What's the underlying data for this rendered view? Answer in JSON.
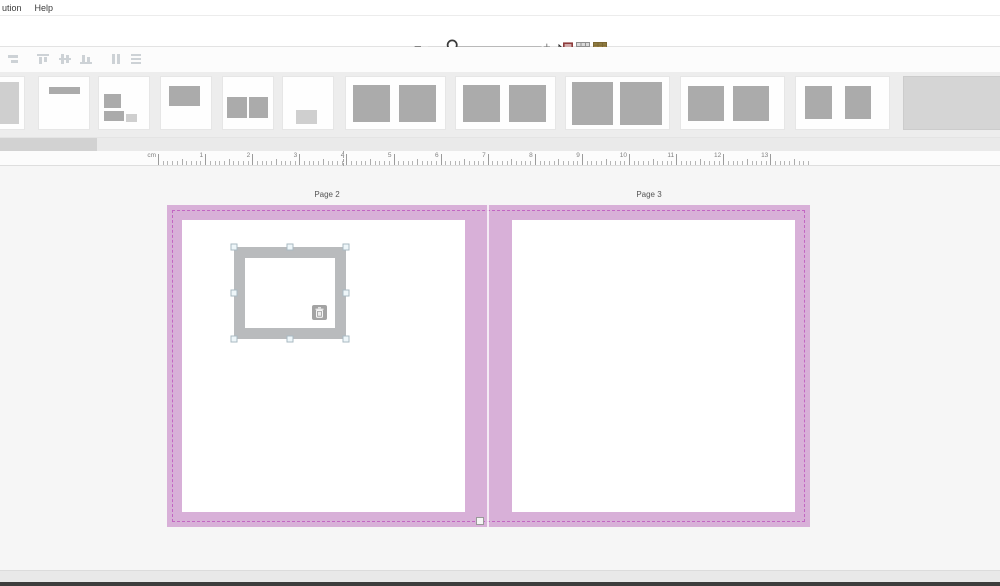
{
  "menu_bar": {
    "items": [
      {
        "id": "ution",
        "label": "ution"
      },
      {
        "id": "help",
        "label": "Help"
      }
    ]
  },
  "zoom_toolbar": {
    "minus_label": "−",
    "plus_label": "+",
    "slider_handle_icon": "magnifier-icon",
    "mode_icons": [
      {
        "name": "drag-drop-cursor-icon"
      },
      {
        "name": "grid-view-icon"
      },
      {
        "name": "photo-grid-view-icon"
      }
    ]
  },
  "align_toolbar": {
    "icons": [
      {
        "name": "align-right-icon"
      },
      {
        "name": "align-top-icon"
      },
      {
        "name": "align-middle-icon"
      },
      {
        "name": "align-bottom-icon"
      },
      {
        "name": "distribute-horizontal-icon"
      },
      {
        "name": "distribute-vertical-icon"
      }
    ]
  },
  "templates_strip": {
    "items": [
      {
        "name": "full-page",
        "x": -28,
        "w": 53,
        "boxes": [
          {
            "x": 8,
            "y": 9,
            "w": 82,
            "h": 82,
            "shade": "light"
          }
        ]
      },
      {
        "name": "title-bar",
        "x": 38,
        "w": 52,
        "boxes": [
          {
            "x": 19,
            "y": 20,
            "w": 62,
            "h": 13,
            "shade": "dark"
          }
        ]
      },
      {
        "name": "image-with-caption",
        "x": 98,
        "w": 52,
        "boxes": [
          {
            "x": 10,
            "y": 33,
            "w": 34,
            "h": 27,
            "shade": "dark"
          },
          {
            "x": 10,
            "y": 65,
            "w": 40,
            "h": 20,
            "shade": "dark"
          },
          {
            "x": 54,
            "y": 72,
            "w": 22,
            "h": 15,
            "shade": "light"
          }
        ]
      },
      {
        "name": "single-image-top",
        "x": 160,
        "w": 52,
        "boxes": [
          {
            "x": 15,
            "y": 18,
            "w": 63,
            "h": 37,
            "shade": "dark"
          }
        ]
      },
      {
        "name": "two-images",
        "x": 222,
        "w": 52,
        "boxes": [
          {
            "x": 8,
            "y": 39,
            "w": 40,
            "h": 39,
            "shade": "dark"
          },
          {
            "x": 52,
            "y": 39,
            "w": 37,
            "h": 39,
            "shade": "dark"
          }
        ]
      },
      {
        "name": "small-caption-bottom",
        "x": 282,
        "w": 52,
        "boxes": [
          {
            "x": 26,
            "y": 64,
            "w": 41,
            "h": 26,
            "shade": "light"
          }
        ]
      },
      {
        "name": "spread-two-images-a",
        "x": 345,
        "w": 101,
        "boxes": [
          {
            "x": 7,
            "y": 15,
            "w": 37,
            "h": 71,
            "shade": "dark"
          },
          {
            "x": 54,
            "y": 15,
            "w": 37,
            "h": 71,
            "shade": "dark"
          }
        ]
      },
      {
        "name": "spread-two-images-b",
        "x": 455,
        "w": 101,
        "boxes": [
          {
            "x": 7,
            "y": 15,
            "w": 37,
            "h": 71,
            "shade": "dark"
          },
          {
            "x": 54,
            "y": 15,
            "w": 37,
            "h": 71,
            "shade": "dark"
          }
        ]
      },
      {
        "name": "spread-two-images-large",
        "x": 565,
        "w": 105,
        "boxes": [
          {
            "x": 6,
            "y": 10,
            "w": 40,
            "h": 83,
            "shade": "dark"
          },
          {
            "x": 52,
            "y": 10,
            "w": 41,
            "h": 83,
            "shade": "dark"
          }
        ]
      },
      {
        "name": "spread-two-images-c",
        "x": 680,
        "w": 105,
        "boxes": [
          {
            "x": 7,
            "y": 17,
            "w": 35,
            "h": 68,
            "shade": "dark"
          },
          {
            "x": 50,
            "y": 17,
            "w": 35,
            "h": 68,
            "shade": "dark"
          }
        ]
      },
      {
        "name": "spread-two-images-narrow",
        "x": 795,
        "w": 95,
        "boxes": [
          {
            "x": 10,
            "y": 17,
            "w": 29,
            "h": 64,
            "shade": "dark"
          },
          {
            "x": 53,
            "y": 17,
            "w": 28,
            "h": 64,
            "shade": "dark"
          }
        ]
      },
      {
        "name": "placeholder-block",
        "x": 903,
        "w": 110,
        "kind": "block",
        "boxes": []
      }
    ]
  },
  "scrollbar": {
    "thumb_x": 0,
    "thumb_w": 97
  },
  "ruler": {
    "unit_label": "cm",
    "origin_px": 158,
    "mm_px": 4.71,
    "total_mm": 138,
    "indicator_x": 343
  },
  "canvas": {
    "page_labels": [
      {
        "label": "Page 2"
      },
      {
        "label": "Page 3"
      }
    ],
    "frame": {
      "x": 67,
      "y": 42,
      "w": 112,
      "h": 92
    }
  },
  "colors": {
    "page_pink": "#d8b0d8",
    "dashed_border": "#c266c2",
    "frame_gray": "#b9bbbd",
    "handle_fill": "#eef6f9",
    "handle_border": "#a9bac2",
    "thumb_dark": "#ababab",
    "thumb_light": "#cfcfcf"
  }
}
